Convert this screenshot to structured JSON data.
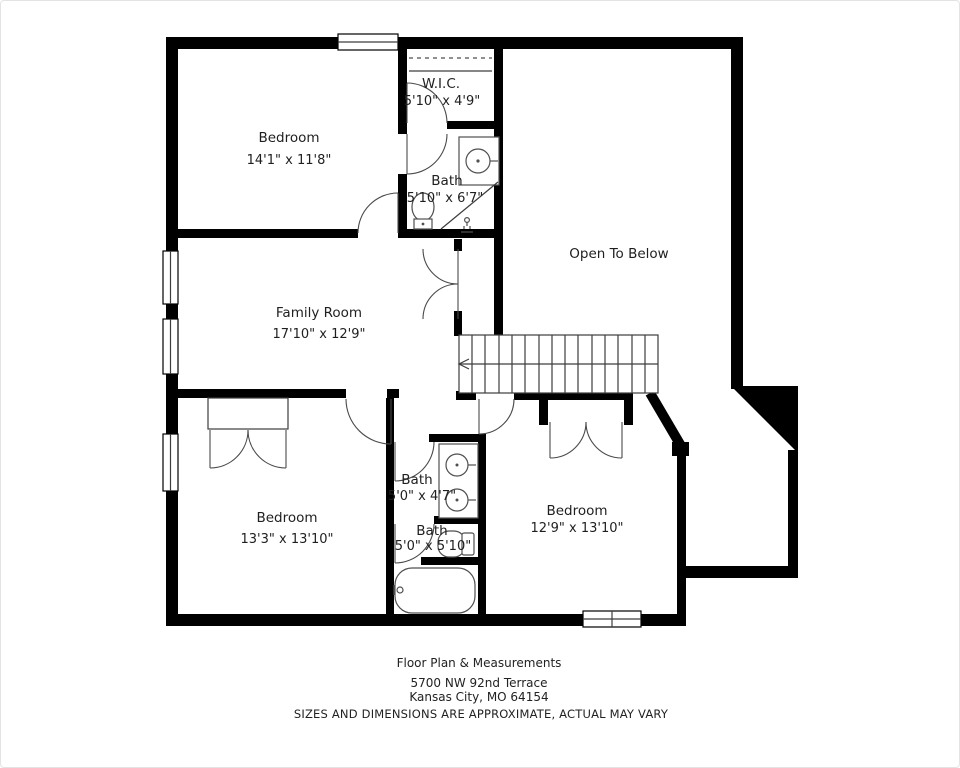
{
  "colors": {
    "background": "#ffffff",
    "wall": "#000000",
    "fixture_line": "#4f4f4f",
    "text": "#1f1f1f"
  },
  "rooms": [
    {
      "name": "Bedroom",
      "dims": "14'1\" x 11'8\""
    },
    {
      "name": "W.I.C.",
      "dims": "5'10\" x 4'9\""
    },
    {
      "name": "Bath",
      "dims": "5'10\" x 6'7\""
    },
    {
      "name": "Open To Below",
      "dims": ""
    },
    {
      "name": "Family Room",
      "dims": "17'10\" x 12'9\""
    },
    {
      "name": "Bedroom",
      "dims": "13'3\" x 13'10\""
    },
    {
      "name": "Bath",
      "dims": "5'0\" x 4'7\""
    },
    {
      "name": "Bath",
      "dims": "5'0\" x 5'10\""
    },
    {
      "name": "Bedroom",
      "dims": "12'9\" x 13'10\""
    }
  ],
  "footer": {
    "title": "Floor Plan & Measurements",
    "address_line1": "5700 NW 92nd Terrace",
    "address_line2": "Kansas City, MO 64154",
    "disclaimer": "SIZES AND DIMENSIONS ARE APPROXIMATE, ACTUAL MAY VARY"
  }
}
